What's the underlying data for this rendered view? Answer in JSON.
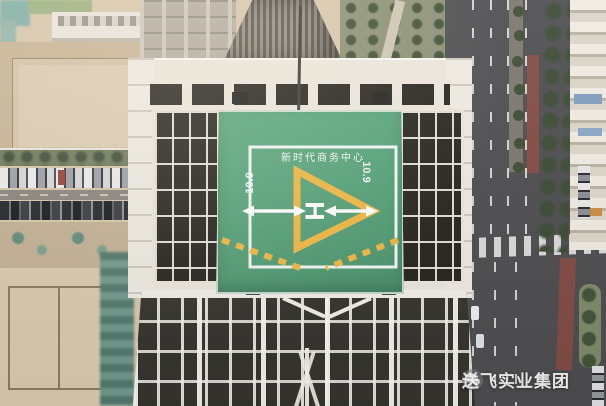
{
  "helipad": {
    "building_name": "新时代商务中心",
    "size_marking_left": "10.9",
    "size_marking_right": "10.9",
    "center_marking": "H"
  },
  "watermark": {
    "icon": "wechat-icon",
    "text": "送飞实业集团"
  },
  "colors": {
    "helipad_green": "#4FA378",
    "marking_yellow": "#F2B73A",
    "marking_white": "#FFFFFF",
    "roof_white": "#ECE7DC",
    "facade_dark": "#35342F",
    "road_gray": "#4D4D50",
    "bus_lane_red": "#92493F",
    "tree_green": "#3C4C34",
    "construction_sand": "#D8C6A9",
    "water_teal": "#7FB0A6"
  }
}
